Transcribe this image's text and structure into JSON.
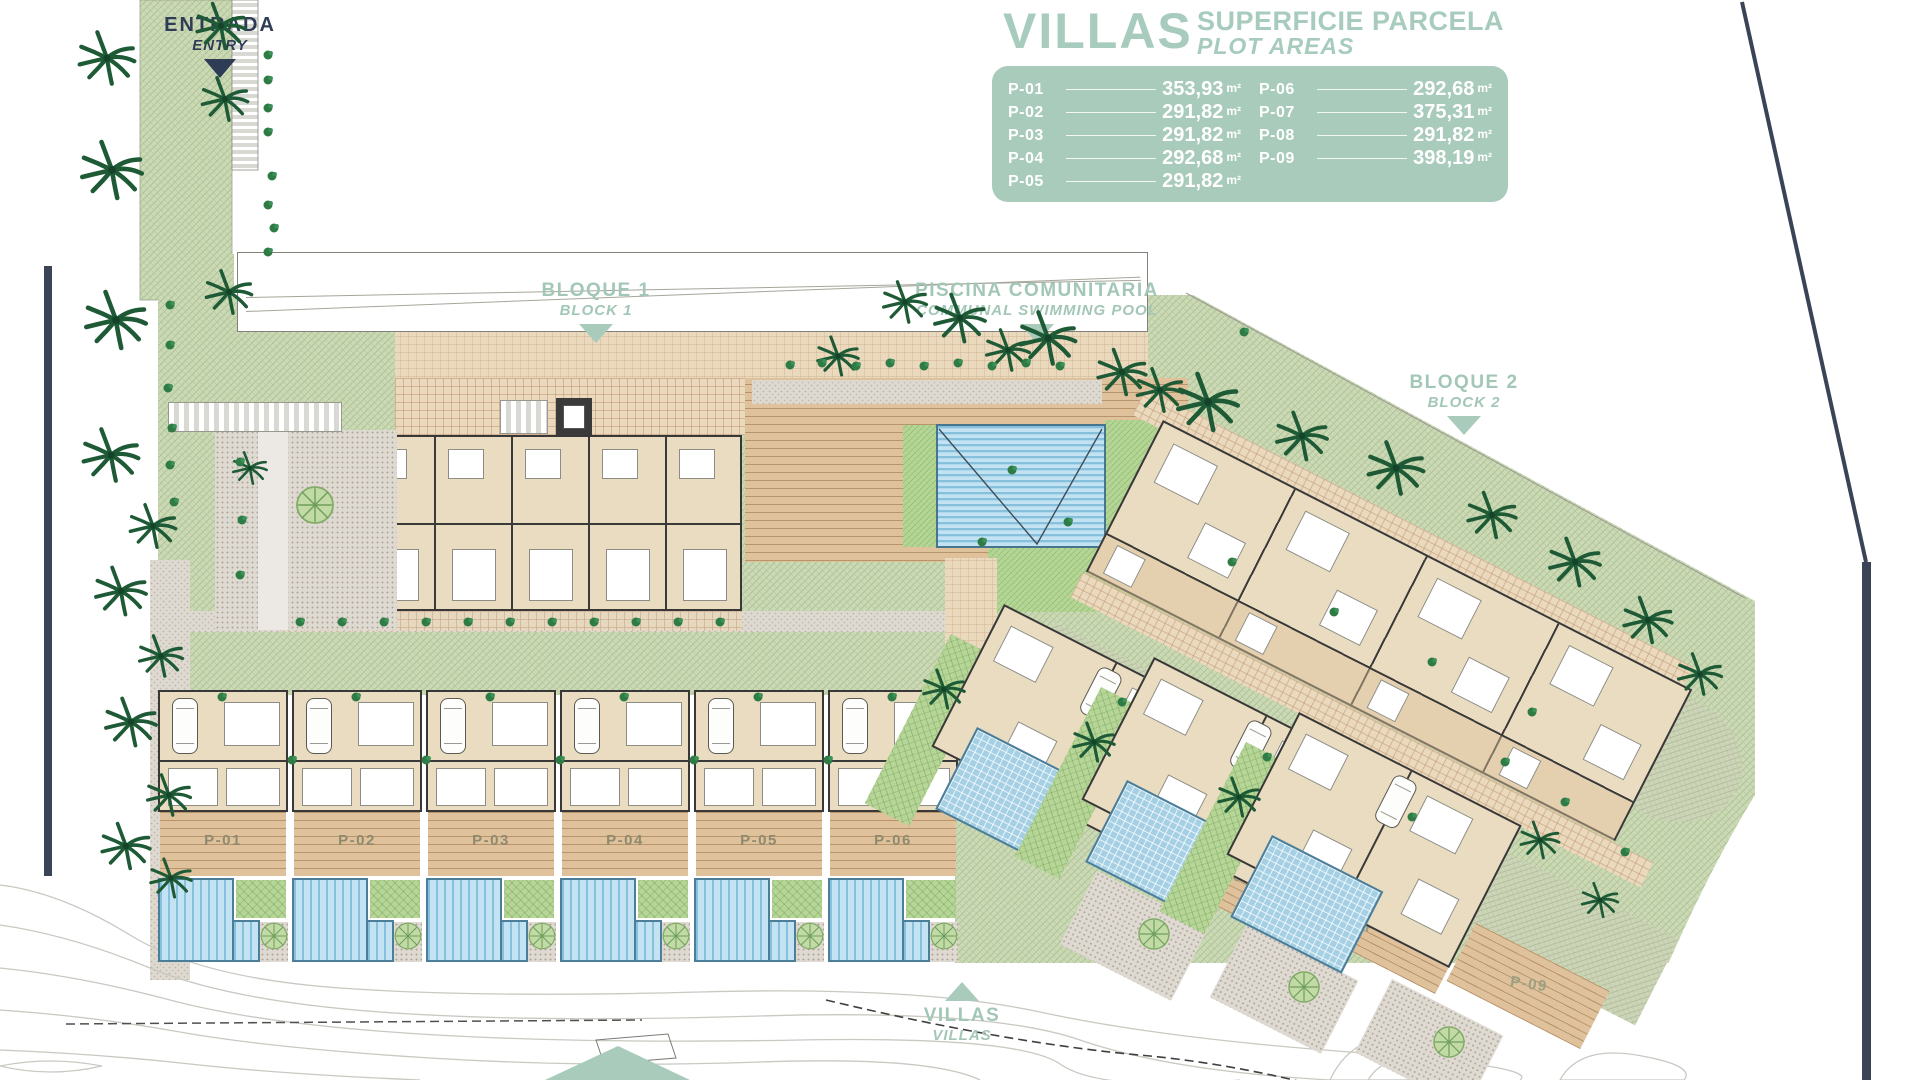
{
  "legend": {
    "title": "VILLAS",
    "subtitle_line1": "SUPERFICIE PARCELA",
    "subtitle_line2": "PLOT AREAS",
    "unit": "m²",
    "plots": [
      {
        "id": "P-01",
        "area": "353,93"
      },
      {
        "id": "P-02",
        "area": "291,82"
      },
      {
        "id": "P-03",
        "area": "291,82"
      },
      {
        "id": "P-04",
        "area": "292,68"
      },
      {
        "id": "P-05",
        "area": "291,82"
      },
      {
        "id": "P-06",
        "area": "292,68"
      },
      {
        "id": "P-07",
        "area": "375,31"
      },
      {
        "id": "P-08",
        "area": "291,82"
      },
      {
        "id": "P-09",
        "area": "398,19"
      }
    ]
  },
  "map_labels": {
    "entry": {
      "primary": "ENTRADA",
      "secondary": "ENTRY"
    },
    "block1": {
      "primary": "BLOQUE 1",
      "secondary": "BLOCK 1"
    },
    "pool": {
      "primary": "PISCINA COMUNITARIA",
      "secondary": "COMMUNAL SWIMMING POOL"
    },
    "block2": {
      "primary": "BLOQUE 2",
      "secondary": "BLOCK 2"
    },
    "villas": {
      "primary": "VILLAS",
      "secondary": "VILLAS"
    }
  },
  "plot_labels_on_plan": {
    "row": [
      "P-01",
      "P-02",
      "P-03",
      "P-04",
      "P-05",
      "P-06"
    ],
    "diagonal": [
      "P-07",
      "P-08",
      "P-09"
    ]
  },
  "colors": {
    "sage": "#a9cbbc",
    "navy": "#32405a",
    "pool_blue": "#c3e3f2",
    "lawn_green": "#cbd9b4"
  }
}
